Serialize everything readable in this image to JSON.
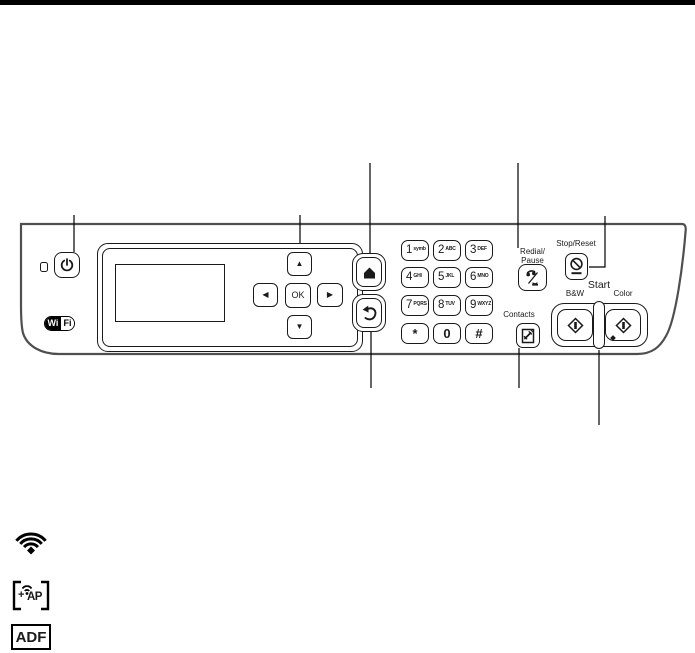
{
  "meta": {
    "description": "Printer control panel diagram with callout lines and status icon legend"
  },
  "colors": {
    "line_black": "#1a1a1a",
    "panel_outline": "#4f4f4f",
    "top_bar": "#000000",
    "white": "#ffffff"
  },
  "panel": {
    "wifi_logo": {
      "wi": "Wi",
      "fi": "Fi"
    },
    "nav": {
      "ok_label": "OK",
      "up_glyph": "▲",
      "down_glyph": "▼",
      "left_glyph": "◀",
      "right_glyph": "▶"
    },
    "keypad": {
      "keys": [
        {
          "digit": "1",
          "letters": "symb"
        },
        {
          "digit": "2",
          "letters": "ABC"
        },
        {
          "digit": "3",
          "letters": "DEF"
        },
        {
          "digit": "4",
          "letters": "GHI"
        },
        {
          "digit": "5",
          "letters": "JKL"
        },
        {
          "digit": "6",
          "letters": "MNO"
        },
        {
          "digit": "7",
          "letters": "PQRS"
        },
        {
          "digit": "8",
          "letters": "TUV"
        },
        {
          "digit": "9",
          "letters": "WXYZ"
        },
        {
          "digit": "*",
          "letters": ""
        },
        {
          "digit": "0",
          "letters": ""
        },
        {
          "digit": "#",
          "letters": ""
        }
      ]
    },
    "fax": {
      "redial_label_line1": "Redial/",
      "redial_label_line2": "Pause",
      "contacts_label": "Contacts"
    },
    "right_cluster": {
      "stop_reset_label": "Stop/Reset",
      "start_label": "Start",
      "bw_label": "B&W",
      "color_label": "Color"
    }
  },
  "legend": {
    "ap_plus": "+",
    "ap_label": "AP",
    "adf_label": "ADF"
  }
}
